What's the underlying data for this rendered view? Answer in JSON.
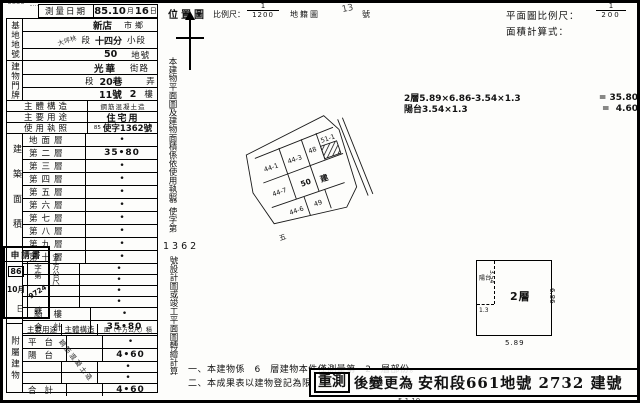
{
  "header": {
    "survey_date_label": "測量日期",
    "survey_date_y": "85.10",
    "survey_date_m": "月",
    "survey_date_d": "16",
    "survey_date_du": "日"
  },
  "site": {
    "label": "基地地號",
    "city": "新店",
    "city_unit": "市鄉",
    "section_written": "大坪林",
    "section_unit": "段",
    "subsection": "十四分",
    "subsection_unit": "小段",
    "lot": "50",
    "lot_unit": "地號"
  },
  "address": {
    "label": "建物門牌",
    "street": "光華",
    "street_unit": "街路",
    "seg_unit": "段",
    "lane": "20巷",
    "alley_unit": "弄",
    "no": "11號",
    "floor_no": "2",
    "floor_unit": "樓"
  },
  "rows": {
    "structure_label": "主體構造",
    "structure_value": "鋼筋混凝土造",
    "use_label": "主要用途",
    "use_value": "住宅用",
    "license_label": "使用執照",
    "license_prefix": "85",
    "license_value": "使字1362號"
  },
  "floors": {
    "side_label": "建築面積",
    "unit_label": "（平方公尺）",
    "rows": [
      {
        "label": "地面層",
        "value": "•"
      },
      {
        "label": "第二層",
        "value": "35•80"
      },
      {
        "label": "第三層",
        "value": "•"
      },
      {
        "label": "第四層",
        "value": "•"
      },
      {
        "label": "第五層",
        "value": "•"
      },
      {
        "label": "第六層",
        "value": "•"
      },
      {
        "label": "第七層",
        "value": "•"
      },
      {
        "label": "第八層",
        "value": "•"
      },
      {
        "label": "第九層",
        "value": "•"
      },
      {
        "label": "第十層",
        "value": "•"
      },
      {
        "label": "",
        "value": "•"
      },
      {
        "label": "",
        "value": "•"
      },
      {
        "label": "",
        "value": "•"
      },
      {
        "label": "",
        "value": "•"
      },
      {
        "label": "騎樓",
        "value": "•"
      },
      {
        "label": "合計",
        "value": "35•80"
      }
    ]
  },
  "application": {
    "title": "申請書",
    "year": "86",
    "month": "10月",
    "day": "日",
    "no_prefix": "字第",
    "no_value": "9724",
    "no_suffix": "號"
  },
  "annex": {
    "side_label": "附屬建物",
    "header_use": "主要用途",
    "header_structure": "主體構造",
    "header_area": "面（平方公尺）積",
    "structure_diagonal": "鋼筋混凝土造",
    "rows": [
      {
        "label": "平台",
        "value": "•"
      },
      {
        "label": "陽台",
        "value": "4•60"
      },
      {
        "label": "",
        "value": "•"
      },
      {
        "label": "",
        "value": "•"
      },
      {
        "label": "合計",
        "value": "4•60"
      }
    ]
  },
  "location_map": {
    "title": "位置圖",
    "scale_label": "比例尺：",
    "scale_num": "1",
    "scale_den": "1200",
    "sheet_label": "地籍圖",
    "sheet_no": "13",
    "sheet_unit": "號",
    "parcels": [
      "44-1",
      "44-3",
      "48",
      "51-1",
      "44-7",
      "50",
      "44-6",
      "49"
    ],
    "subject_char": "建",
    "margin_char": "五"
  },
  "vertical_note": {
    "part1": "本建物平面圖及建物面積係依使用執照",
    "small": "85",
    "part2": "使字第",
    "number": "1362",
    "part3": "號設計圖或竣工平面圖轉繪計算"
  },
  "plan": {
    "scale_label": "平面圖比例尺：",
    "scale_num": "1",
    "scale_den": "200",
    "calc_label": "面積計算式：",
    "formula1_expr": "2層5.89×6.86-3.54×1.3",
    "formula1_result": "= 35.80",
    "formula2_expr": "陽台3.54×1.3",
    "formula2_result": "=  4.60",
    "floor_label": "2層",
    "balcony_label": "陽台",
    "dim_w": "5.89",
    "dim_h": "6.86",
    "dim_bal_h": "3.54",
    "dim_bal_w": "1.3"
  },
  "notes": {
    "line1": "一、本建物係　6　層建物本件僅測量第　2　層部份。",
    "line2": "二、本成果表以建物登記為限"
  },
  "stamp": {
    "boxed": "重測",
    "middle": "後變更為",
    "location": "安和段661地號 2732 建號"
  },
  "misc": {
    "bottom_partial": "5.1.10"
  }
}
